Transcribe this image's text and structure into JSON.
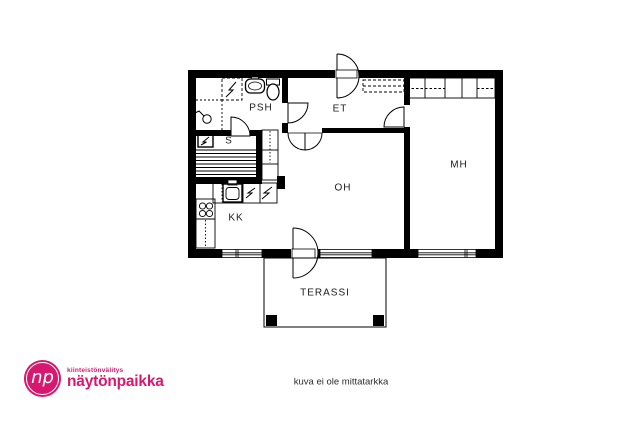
{
  "floorplan": {
    "rooms": {
      "psh": "PSH",
      "s": "S",
      "et": "ET",
      "oh": "OH",
      "mh": "MH",
      "kk": "KK",
      "terassi": "TERASSI"
    },
    "caption": "kuva ei ole mittatarkka"
  },
  "branding": {
    "monogram": "np",
    "tagline": "kiinteistönvälitys",
    "name": "näytönpaikka",
    "color": "#d8186f"
  }
}
